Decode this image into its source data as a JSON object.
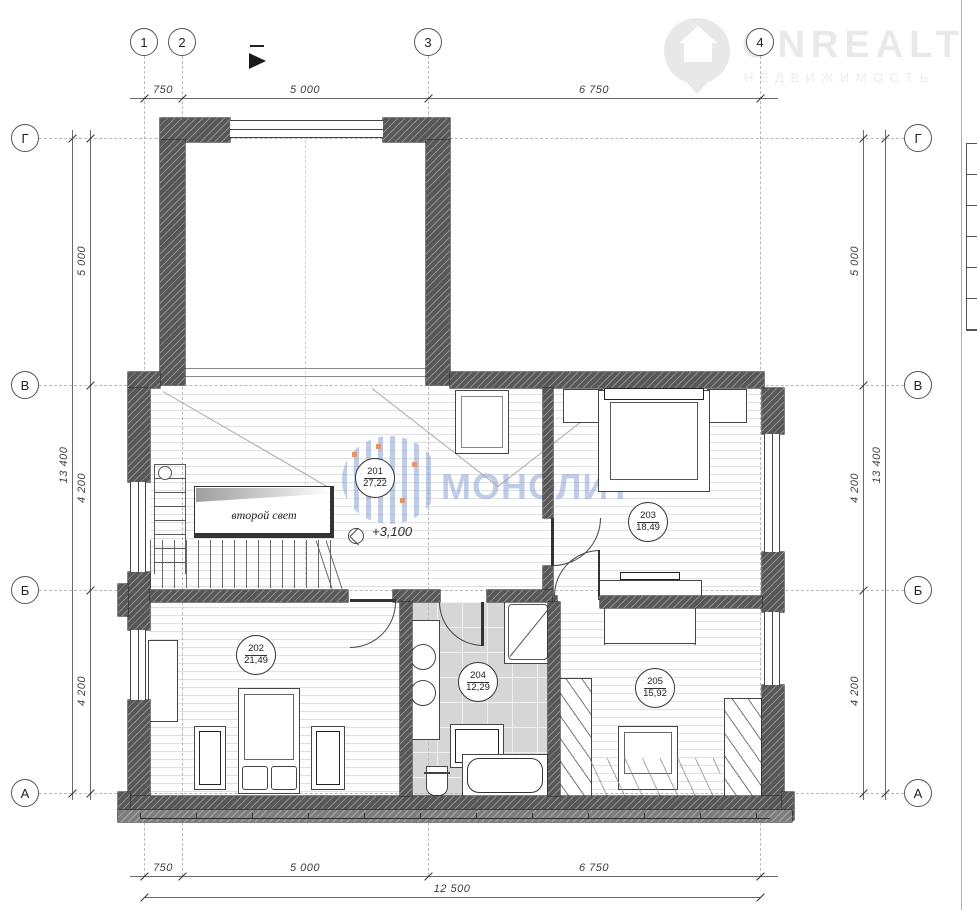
{
  "axes": {
    "top": [
      "1",
      "2",
      "3",
      "4"
    ],
    "left": [
      "Г",
      "В",
      "Б",
      "А"
    ],
    "right": [
      "Г",
      "В",
      "Б",
      "А"
    ]
  },
  "dims": {
    "top": [
      "750",
      "5 000",
      "6 750"
    ],
    "bottom": [
      "750",
      "5 000",
      "6 750"
    ],
    "bottom_total": "12 500",
    "left": [
      "5 000",
      "4 200",
      "4 200"
    ],
    "left_total": "13 400",
    "right": [
      "5 000",
      "4 200",
      "4 200"
    ],
    "right_total": "13 400"
  },
  "rooms": [
    {
      "number": "201",
      "area": "27,22"
    },
    {
      "number": "202",
      "area": "21,49"
    },
    {
      "number": "203",
      "area": "18,49"
    },
    {
      "number": "204",
      "area": "12,29"
    },
    {
      "number": "205",
      "area": "15,92"
    }
  ],
  "labels": {
    "void": "второй свет",
    "level": "+3,100"
  },
  "watermark": {
    "text": "МОНОЛИТ"
  },
  "logo": {
    "text": "ONREALT",
    "subtext": "НЕДВИЖИМОСТЬ"
  },
  "colors": {
    "wall": "#575757",
    "watermark": "#8da3d6",
    "tile": "#d6d6d6",
    "accent_dot_orange": "#e0956e"
  }
}
